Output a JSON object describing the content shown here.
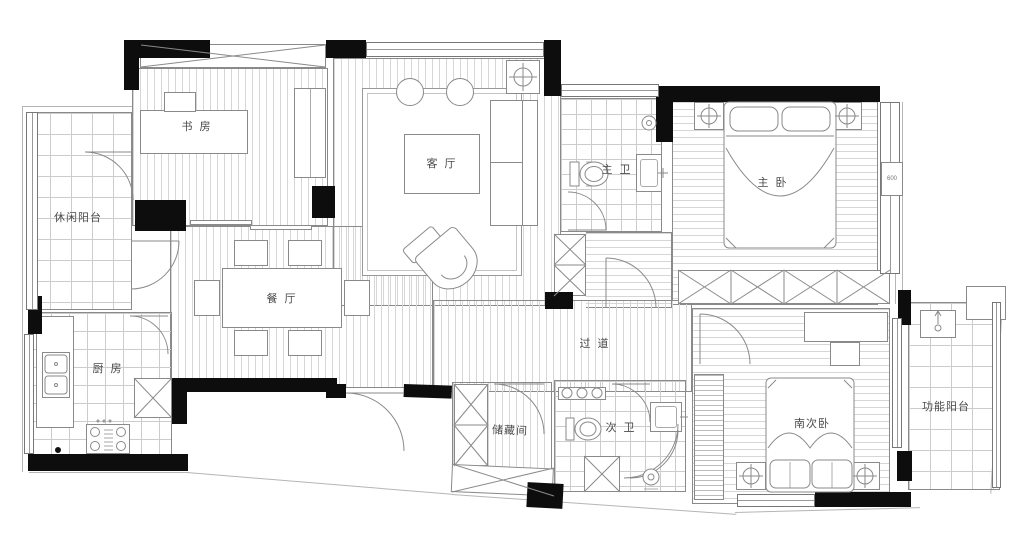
{
  "rooms": {
    "study": {
      "label": "书 房"
    },
    "living": {
      "label": "客 厅"
    },
    "leisure_balcony": {
      "label": "休闲阳台"
    },
    "dining": {
      "label": "餐 厅"
    },
    "kitchen": {
      "label": "厨 房"
    },
    "master_bath": {
      "label": "主 卫"
    },
    "master_bedroom": {
      "label": "主 卧"
    },
    "corridor": {
      "label": "过 道"
    },
    "storage": {
      "label": "储藏间"
    },
    "second_bath": {
      "label": "次 卫"
    },
    "south_bedroom": {
      "label": "南次卧"
    },
    "functional_balcony": {
      "label": "功能阳台"
    }
  },
  "dimensions": {
    "master_bay_width": "600"
  },
  "colors": {
    "wall": "#0d0d0d",
    "line": "#8a8a8a",
    "hatch": "#d6d6d6",
    "text": "#4a4a4a",
    "background": "#ffffff"
  }
}
